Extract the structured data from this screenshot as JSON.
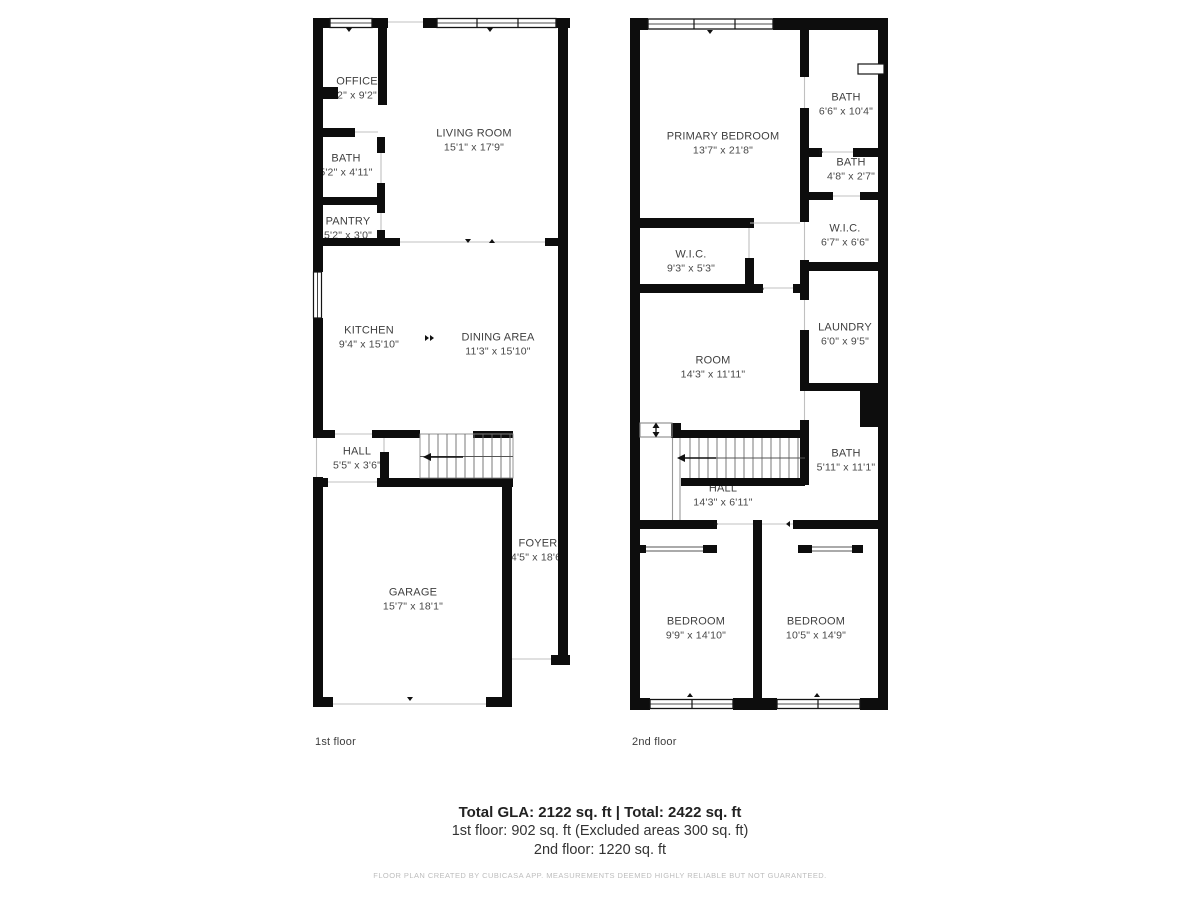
{
  "colors": {
    "wall": "#0d0d0d",
    "room_text": "#3f3f3f",
    "summary_text": "#222222",
    "muted_text": "#bdbdbd"
  },
  "floor1": {
    "caption": "1st floor",
    "rooms": [
      {
        "name": "OFFICE",
        "dims": "2\" x 9'2\""
      },
      {
        "name": "LIVING ROOM",
        "dims": "15'1\" x 17'9\""
      },
      {
        "name": "BATH",
        "dims": "5'2\" x 4'11\""
      },
      {
        "name": "PANTRY",
        "dims": "5'2\" x 3'0\""
      },
      {
        "name": "KITCHEN",
        "dims": "9'4\" x 15'10\""
      },
      {
        "name": "DINING AREA",
        "dims": "11'3\" x 15'10\""
      },
      {
        "name": "HALL",
        "dims": "5'5\" x 3'6\""
      },
      {
        "name": "FOYER",
        "dims": "4'5\" x 18'6\""
      },
      {
        "name": "GARAGE",
        "dims": "15'7\" x 18'1\""
      }
    ]
  },
  "floor2": {
    "caption": "2nd floor",
    "rooms": [
      {
        "name": "PRIMARY BEDROOM",
        "dims": "13'7\" x 21'8\""
      },
      {
        "name": "BATH",
        "dims": "6'6\" x 10'4\""
      },
      {
        "name": "BATH",
        "dims": "4'8\" x 2'7\""
      },
      {
        "name": "W.I.C.",
        "dims": "6'7\" x 6'6\""
      },
      {
        "name": "W.I.C.",
        "dims": "9'3\" x 5'3\""
      },
      {
        "name": "LAUNDRY",
        "dims": "6'0\" x 9'5\""
      },
      {
        "name": "ROOM",
        "dims": "14'3\" x 11'11\""
      },
      {
        "name": "BATH",
        "dims": "5'11\" x 11'1\""
      },
      {
        "name": "HALL",
        "dims": "14'3\" x 6'11\""
      },
      {
        "name": "BEDROOM",
        "dims": "9'9\" x 14'10\""
      },
      {
        "name": "BEDROOM",
        "dims": "10'5\" x 14'9\""
      }
    ]
  },
  "summary": {
    "line1": "Total GLA: 2122 sq. ft | Total: 2422 sq. ft",
    "line2": "1st floor: 902 sq. ft (Excluded areas 300 sq. ft)",
    "line3": "2nd floor: 1220 sq. ft",
    "disclaimer": "FLOOR PLAN CREATED BY CUBICASA APP. MEASUREMENTS DEEMED HIGHLY RELIABLE BUT NOT GUARANTEED."
  }
}
